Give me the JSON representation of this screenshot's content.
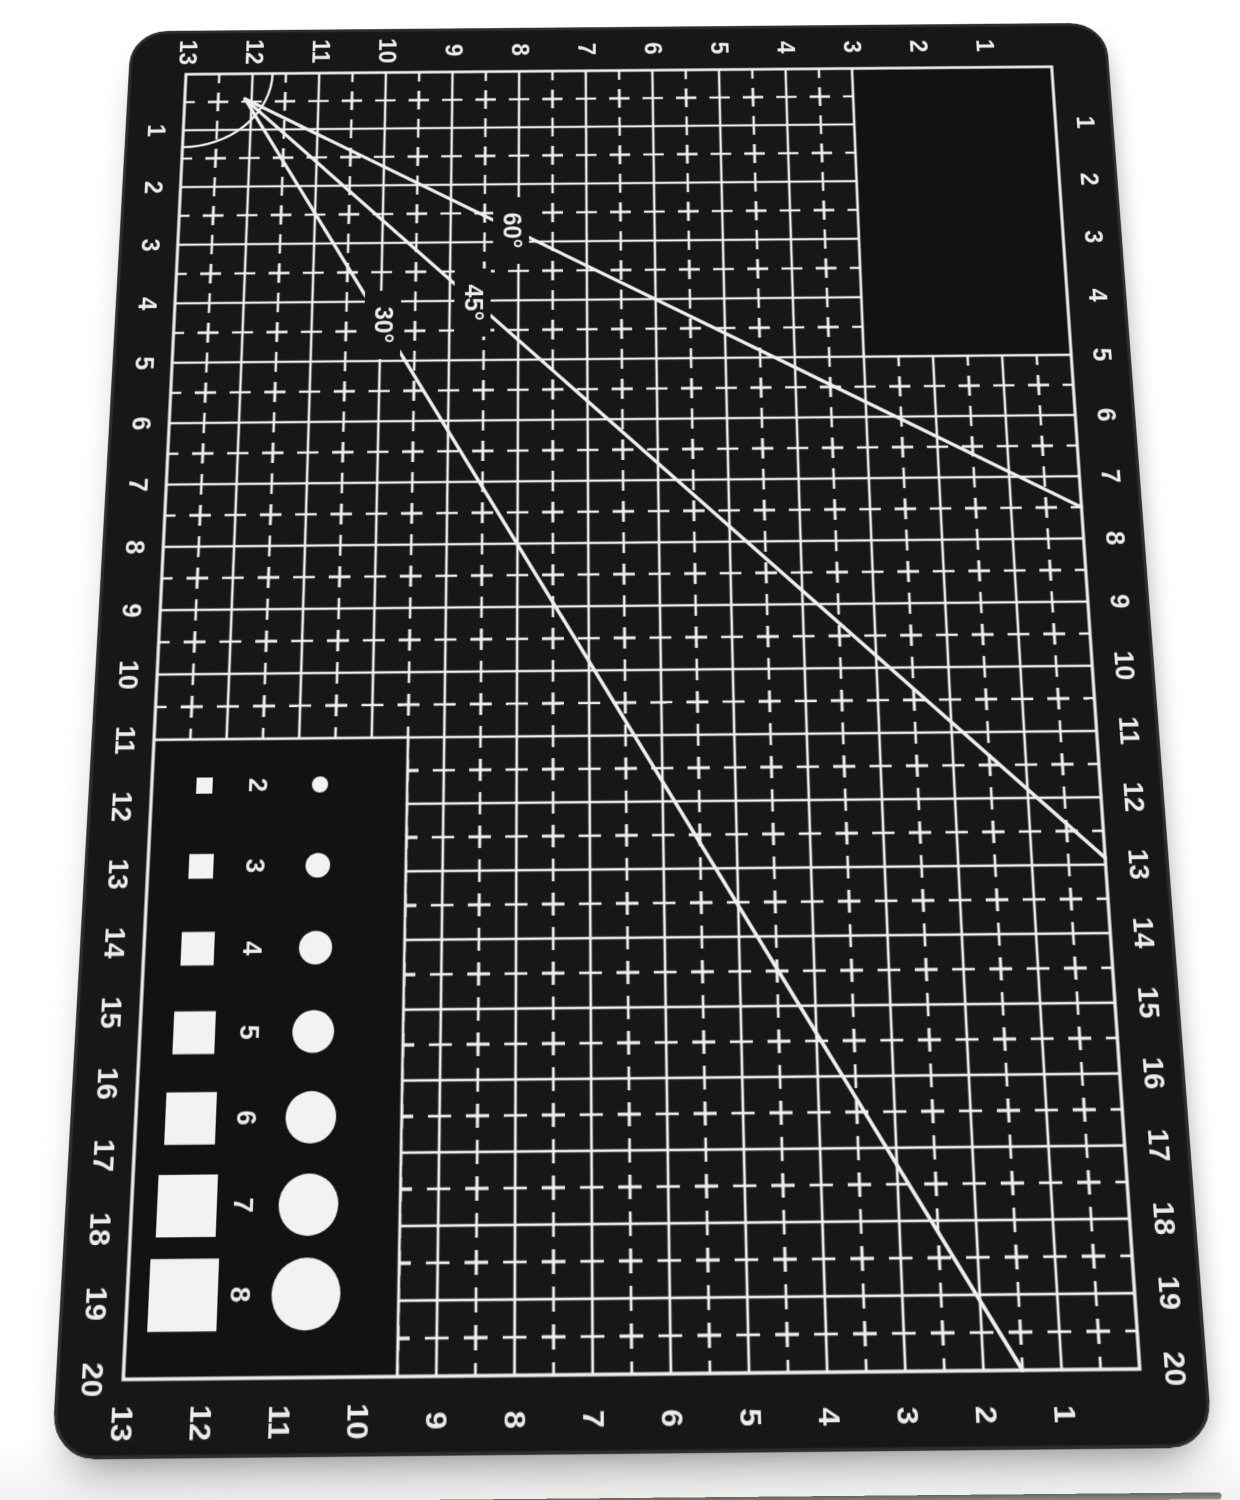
{
  "mat": {
    "colors": {
      "background": "#ffffff",
      "mat_surface": "#171717",
      "blank_area": "#121212",
      "print": "#efefef",
      "print_text": "#ececec",
      "mat_edge": "#2e2e2e",
      "shape_fill": "#f2f2f2"
    },
    "grid": {
      "columns": 13,
      "rows": 20
    },
    "edge_numbers": {
      "top": [
        "13",
        "12",
        "11",
        "10",
        "9",
        "8",
        "7",
        "6",
        "5",
        "4",
        "3",
        "2",
        "1"
      ],
      "bottom": [
        "13",
        "12",
        "11",
        "10",
        "9",
        "8",
        "7",
        "6",
        "5",
        "4",
        "3",
        "2",
        "1"
      ],
      "left": [
        "1",
        "2",
        "3",
        "4",
        "5",
        "6",
        "7",
        "8",
        "9",
        "10",
        "11",
        "12",
        "13",
        "14",
        "15",
        "16",
        "17",
        "18",
        "19",
        "20"
      ],
      "right": [
        "1",
        "2",
        "3",
        "4",
        "5",
        "6",
        "7",
        "8",
        "9",
        "10",
        "11",
        "12",
        "13",
        "14",
        "15",
        "16",
        "17",
        "18",
        "19",
        "20"
      ]
    },
    "angle_lines": [
      {
        "label": "60°",
        "angle_deg": 60
      },
      {
        "label": "45°",
        "angle_deg": 45
      },
      {
        "label": "30°",
        "angle_deg": 30
      }
    ],
    "size_samples": {
      "labels": [
        "2",
        "3",
        "4",
        "5",
        "6",
        "7",
        "8"
      ]
    }
  }
}
